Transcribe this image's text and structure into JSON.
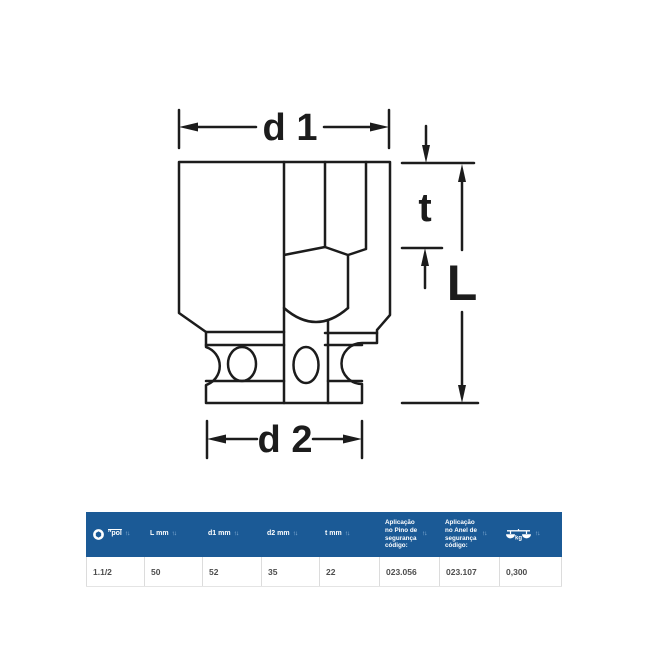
{
  "diagram": {
    "labels": {
      "d1": "d 1",
      "t": "t",
      "L": "L",
      "d2": "d 2"
    },
    "stroke_color": "#1c1c1c"
  },
  "icons": {
    "sort": "↑↓",
    "size_column_icon": "hex-socket-icon",
    "weight_column_icon": "balance-scale-kg-icon"
  },
  "table": {
    "header_bg": "#1b5a96",
    "row_text_color": "#4d4d4d",
    "columns": [
      {
        "id": "pol",
        "label": "″pol"
      },
      {
        "id": "L_mm",
        "label": "L mm"
      },
      {
        "id": "d1_mm",
        "label": "d1 mm"
      },
      {
        "id": "d2_mm",
        "label": "d2 mm"
      },
      {
        "id": "t_mm",
        "label": "t mm"
      },
      {
        "id": "pino",
        "label": "Aplicação no Pino de segurança código:"
      },
      {
        "id": "anel",
        "label": "Aplicação no Anel de segurança código:"
      },
      {
        "id": "kg",
        "label": "kg"
      }
    ],
    "rows": [
      {
        "pol": "1.1/2",
        "L_mm": "50",
        "d1_mm": "52",
        "d2_mm": "35",
        "t_mm": "22",
        "pino": "023.056",
        "anel": "023.107",
        "kg": "0,300"
      }
    ]
  }
}
